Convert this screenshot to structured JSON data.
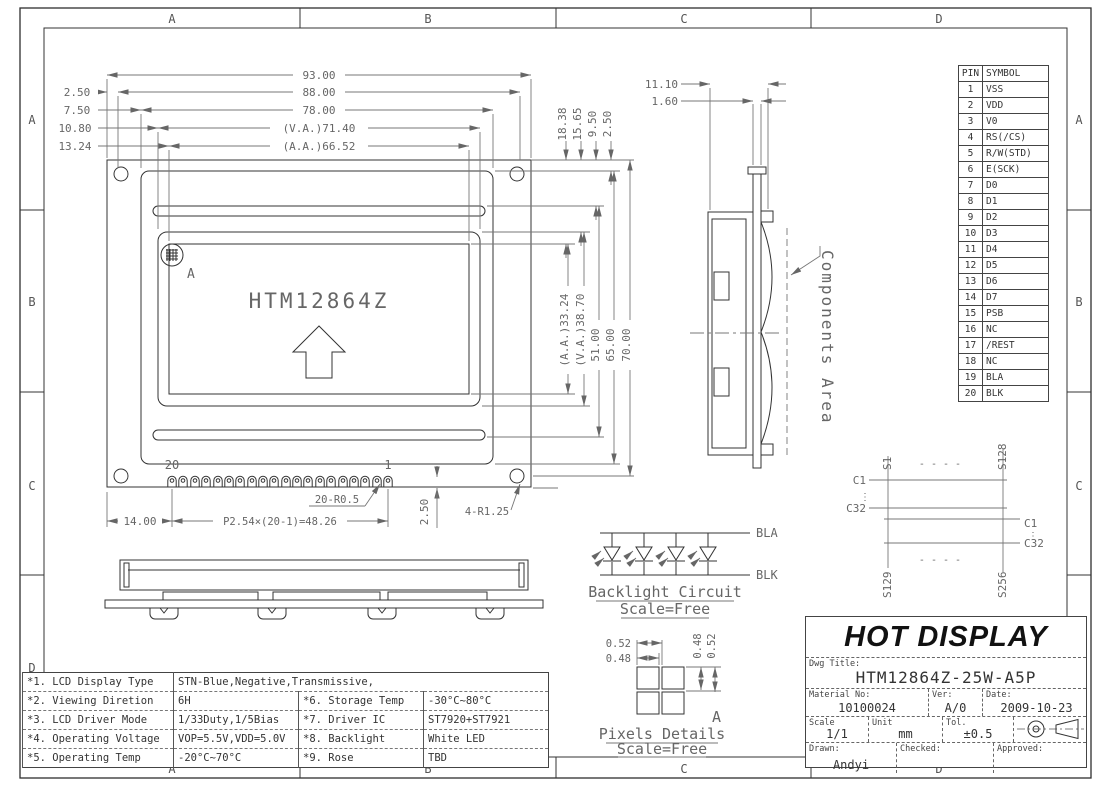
{
  "zones": {
    "letters": [
      "A",
      "B",
      "C",
      "D"
    ]
  },
  "front_view": {
    "logo": "HTM12864Z",
    "detail_label": "A",
    "pin_left": "20",
    "pin_right": "1",
    "dims": {
      "width_total": "93.00",
      "width_88": "88.00",
      "width_78": "78.00",
      "width_va": "(V.A.)71.40",
      "width_aa": "(A.A.)66.52",
      "off_250": "2.50",
      "off_750": "7.50",
      "off_1080": "10.80",
      "off_1324": "13.24",
      "top_1838": "18.38",
      "top_1565": "15.65",
      "top_950": "9.50",
      "top_250": "2.50",
      "h_aa": "(A.A.)33.24",
      "h_va": "(V.A.)38.70",
      "h_51": "51.00",
      "h_65": "65.00",
      "h_70": "70.00",
      "left_margin": "14.00",
      "pitch": "P2.54×(20-1)=48.26",
      "pin_radius": "20-R0.5",
      "pin_drop": "2.50",
      "hole_radius": "4-R1.25"
    }
  },
  "side_view": {
    "dims": {
      "total": "11.10",
      "pcb": "1.60"
    },
    "components_label": "Components Area"
  },
  "backlight": {
    "title": "Backlight Circuit",
    "scale": "Scale=Free",
    "anode": "BLA",
    "cathode": "BLK"
  },
  "pixels": {
    "title": "Pixels Details",
    "scale": "Scale=Free",
    "pitch_h": "0.52",
    "size_h": "0.48",
    "size_v": "0.48",
    "pitch_v": "0.52",
    "detail_label": "A"
  },
  "segments": {
    "s1": "S1",
    "s128": "S128",
    "s129": "S129",
    "s256": "S256",
    "c1": "C1",
    "c32": "C32",
    "hdots": "- - - -",
    "vdots": "⋮"
  },
  "pin_table": {
    "headers": [
      "PIN",
      "SYMBOL"
    ],
    "rows": [
      [
        "1",
        "VSS"
      ],
      [
        "2",
        "VDD"
      ],
      [
        "3",
        "V0"
      ],
      [
        "4",
        "RS(/CS)"
      ],
      [
        "5",
        "R/W(STD)"
      ],
      [
        "6",
        "E(SCK)"
      ],
      [
        "7",
        "D0"
      ],
      [
        "8",
        "D1"
      ],
      [
        "9",
        "D2"
      ],
      [
        "10",
        "D3"
      ],
      [
        "11",
        "D4"
      ],
      [
        "12",
        "D5"
      ],
      [
        "13",
        "D6"
      ],
      [
        "14",
        "D7"
      ],
      [
        "15",
        "PSB"
      ],
      [
        "16",
        "NC"
      ],
      [
        "17",
        "/REST"
      ],
      [
        "18",
        "NC"
      ],
      [
        "19",
        "BLA"
      ],
      [
        "20",
        "BLK"
      ]
    ]
  },
  "spec_table": {
    "rows": {
      "r1": [
        "*1. LCD Display Type",
        "STN-Blue,Negative,Transmissive,"
      ],
      "r2": [
        "*2. Viewing Diretion",
        "6H",
        "*6. Storage Temp",
        "-30°C~80°C"
      ],
      "r3": [
        "*3. LCD Driver Mode",
        "1/33Duty,1/5Bias",
        "*7. Driver IC",
        "ST7920+ST7921"
      ],
      "r4": [
        "*4. Operating Voltage",
        "VOP=5.5V,VDD=5.0V",
        "*8. Backlight",
        "White LED"
      ],
      "r5": [
        "*5. Operating Temp",
        "-20°C~70°C",
        "*9. Rose",
        "TBD"
      ]
    }
  },
  "title_block": {
    "company": "HOT DISPLAY",
    "dwg_label": "Dwg Title:",
    "dwg": "HTM12864Z-25W-A5P",
    "material_label": "Material No:",
    "material": "10100024",
    "ver_label": "Ver:",
    "ver": "A/0",
    "date_label": "Date:",
    "date": "2009-10-23",
    "scale_label": "Scale",
    "scale": "1/1",
    "unit_label": "Unit",
    "unit": "mm",
    "tol_label": "Tol.",
    "tol": "±0.5",
    "drawn_label": "Drawn:",
    "drawn": "Andyi",
    "checked_label": "Checked:",
    "approved_label": "Approved:"
  }
}
